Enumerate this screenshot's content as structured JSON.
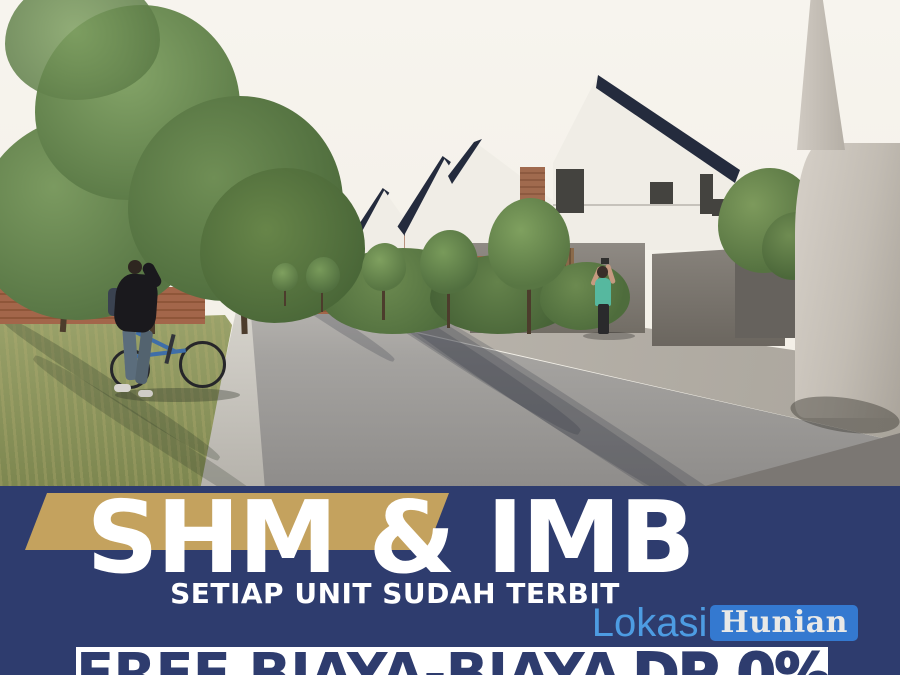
{
  "theme": {
    "navy": "#2e3c6e",
    "gold": "#c4a25e",
    "banner-text": "#ffffff",
    "promo-band": "#ffffff",
    "promo-text": "#2e3c6e",
    "logo-first-color": "#4d9ce2",
    "logo-box-color": "#3479d0",
    "logo-second-color": "#e9e9e7",
    "sky": "#f5f2ea",
    "roof": "#242b3d",
    "house-white": "#f0ede6",
    "concrete": "#8d8882",
    "light-concrete": "#c9c3ba",
    "brick": "#9c6247",
    "grass-green": "#8d965f",
    "road-gray": "#9a9896",
    "tree-green": "#5d7c45"
  },
  "banner": {
    "headline": "SHM & IMB",
    "subheadline": "SETIAP UNIT SUDAH TERBIT",
    "promo_prefix": "FREE BIAYA-BIAYA",
    "promo_highlight": "DP 0%"
  },
  "logo": {
    "first": "Lokasi",
    "second": "Hunian"
  }
}
